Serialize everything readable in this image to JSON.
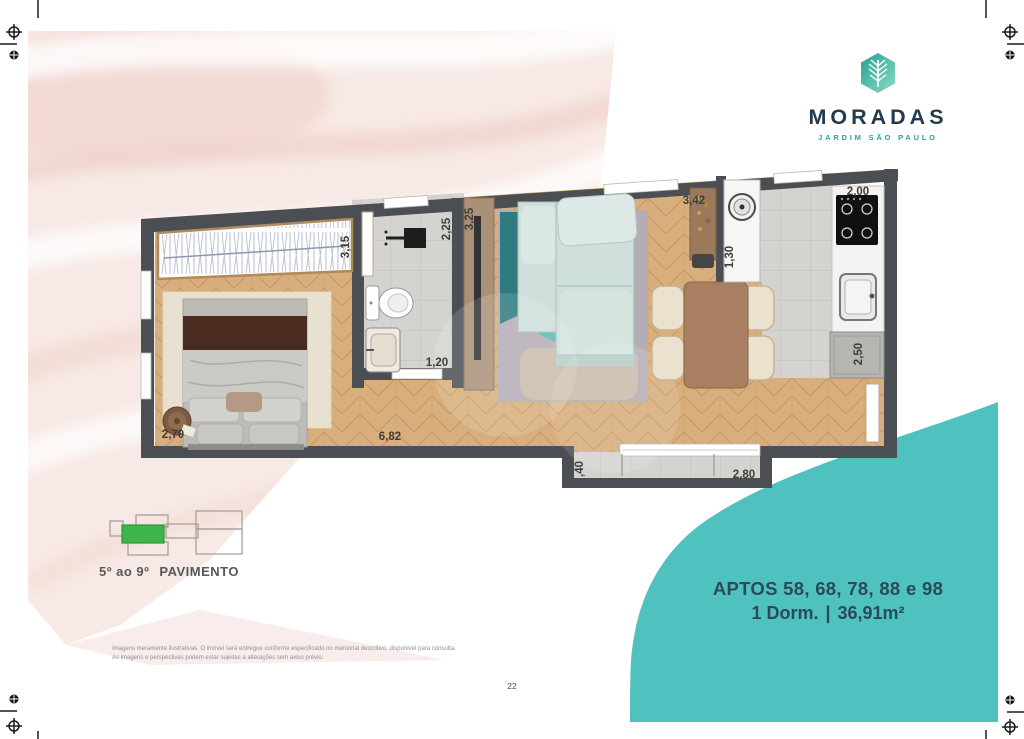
{
  "page": {
    "number": "22"
  },
  "brand": {
    "name": "MORADAS",
    "tagline": "JARDIM SÃO PAULO"
  },
  "floor_key": {
    "range": "5º ao 9º",
    "word": "PAVIMENTO"
  },
  "unit": {
    "line1": "APTOS 58, 68, 78, 88 e 98",
    "dorm": "1 Dorm.",
    "sep": "|",
    "area": "36,91m²"
  },
  "plan": {
    "dims": {
      "wardrobe": "3,15",
      "shower": "2,25",
      "living": "3,25",
      "service": "3,42",
      "kitchen": "2,00",
      "laundry": "1,30",
      "bathroom": "1,20",
      "bedroom": "2,70",
      "hall": "6,82",
      "counter": "2,50",
      "balcony_depth": ",40",
      "balcony_width": "2,80"
    }
  },
  "footer": {
    "line1": "Imagens meramente ilustrativas. O imóvel será entregue conforme especificado no memorial descritivo, disponível para consulta.",
    "line2": "As imagens e perspectivas podem estar sujeitas a alterações sem aviso prévio."
  },
  "colors": {
    "panel_teal": "#4fc2c0",
    "key_green": "#3cb54a",
    "brand_navy": "#223a4d",
    "brand_teal": "#2ea19e",
    "wall_gray": "#4b4f54"
  }
}
